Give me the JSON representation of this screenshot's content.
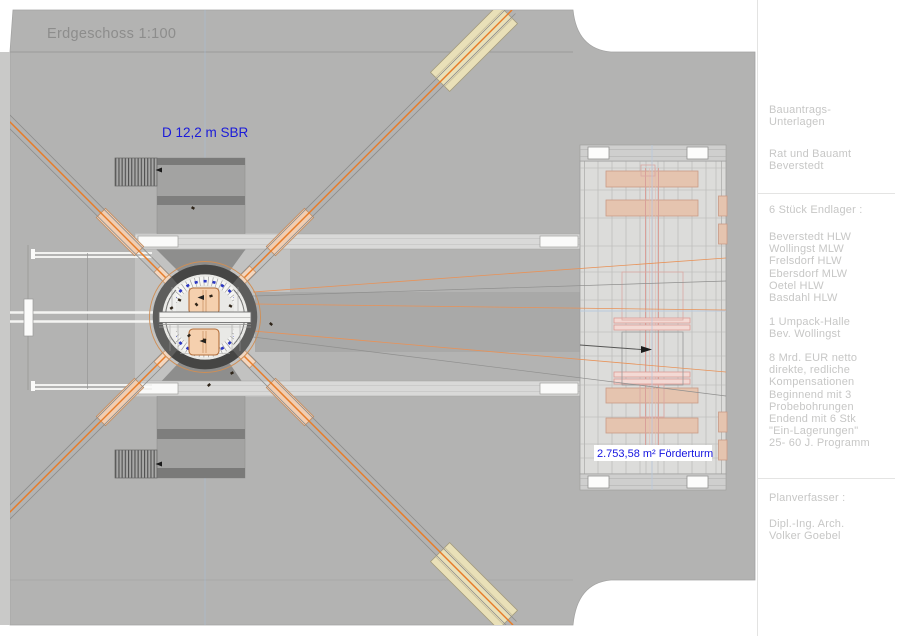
{
  "title": "Erdgeschoss 1:100",
  "plan_labels": {
    "shaft": "D 12,2 m SBR",
    "foerderturm": "2.753,58 m² Förderturm"
  },
  "sidebar": {
    "block_bauantrag": "Bauantrags-\nUnterlagen",
    "block_amt": "Rat und Bauamt\nBeverstedt",
    "block_endlager_heading": "6 Stück Endlager :",
    "block_endlager_list": "Beverstedt HLW\nWollingst MLW\nFrelsdorf HLW\nEbersdorf MLW\nOetel HLW\nBasdahl HLW",
    "block_umpack": "1 Umpack-Halle\nBev. Wollingst",
    "block_kompensation": "8 Mrd. EUR netto\ndirekte, redliche\nKompensationen\nBeginnend mit 3\nProbebohrungen\nEndend mit 6 Stk\n\"Ein-Lagerungen\"\n25- 60 J. Programm",
    "block_planverfasser_heading": "Planverfasser :",
    "block_planverfasser": "Dipl.-Ing. Arch.\nVolker Goebel"
  },
  "colors": {
    "main_gray": "#b3b3b2",
    "label_blue": "#1b1bd9",
    "conveyor_orange": "#e87c28",
    "salmon_fill": "#e5c4af",
    "ring_gray": "#5d5d5c"
  }
}
